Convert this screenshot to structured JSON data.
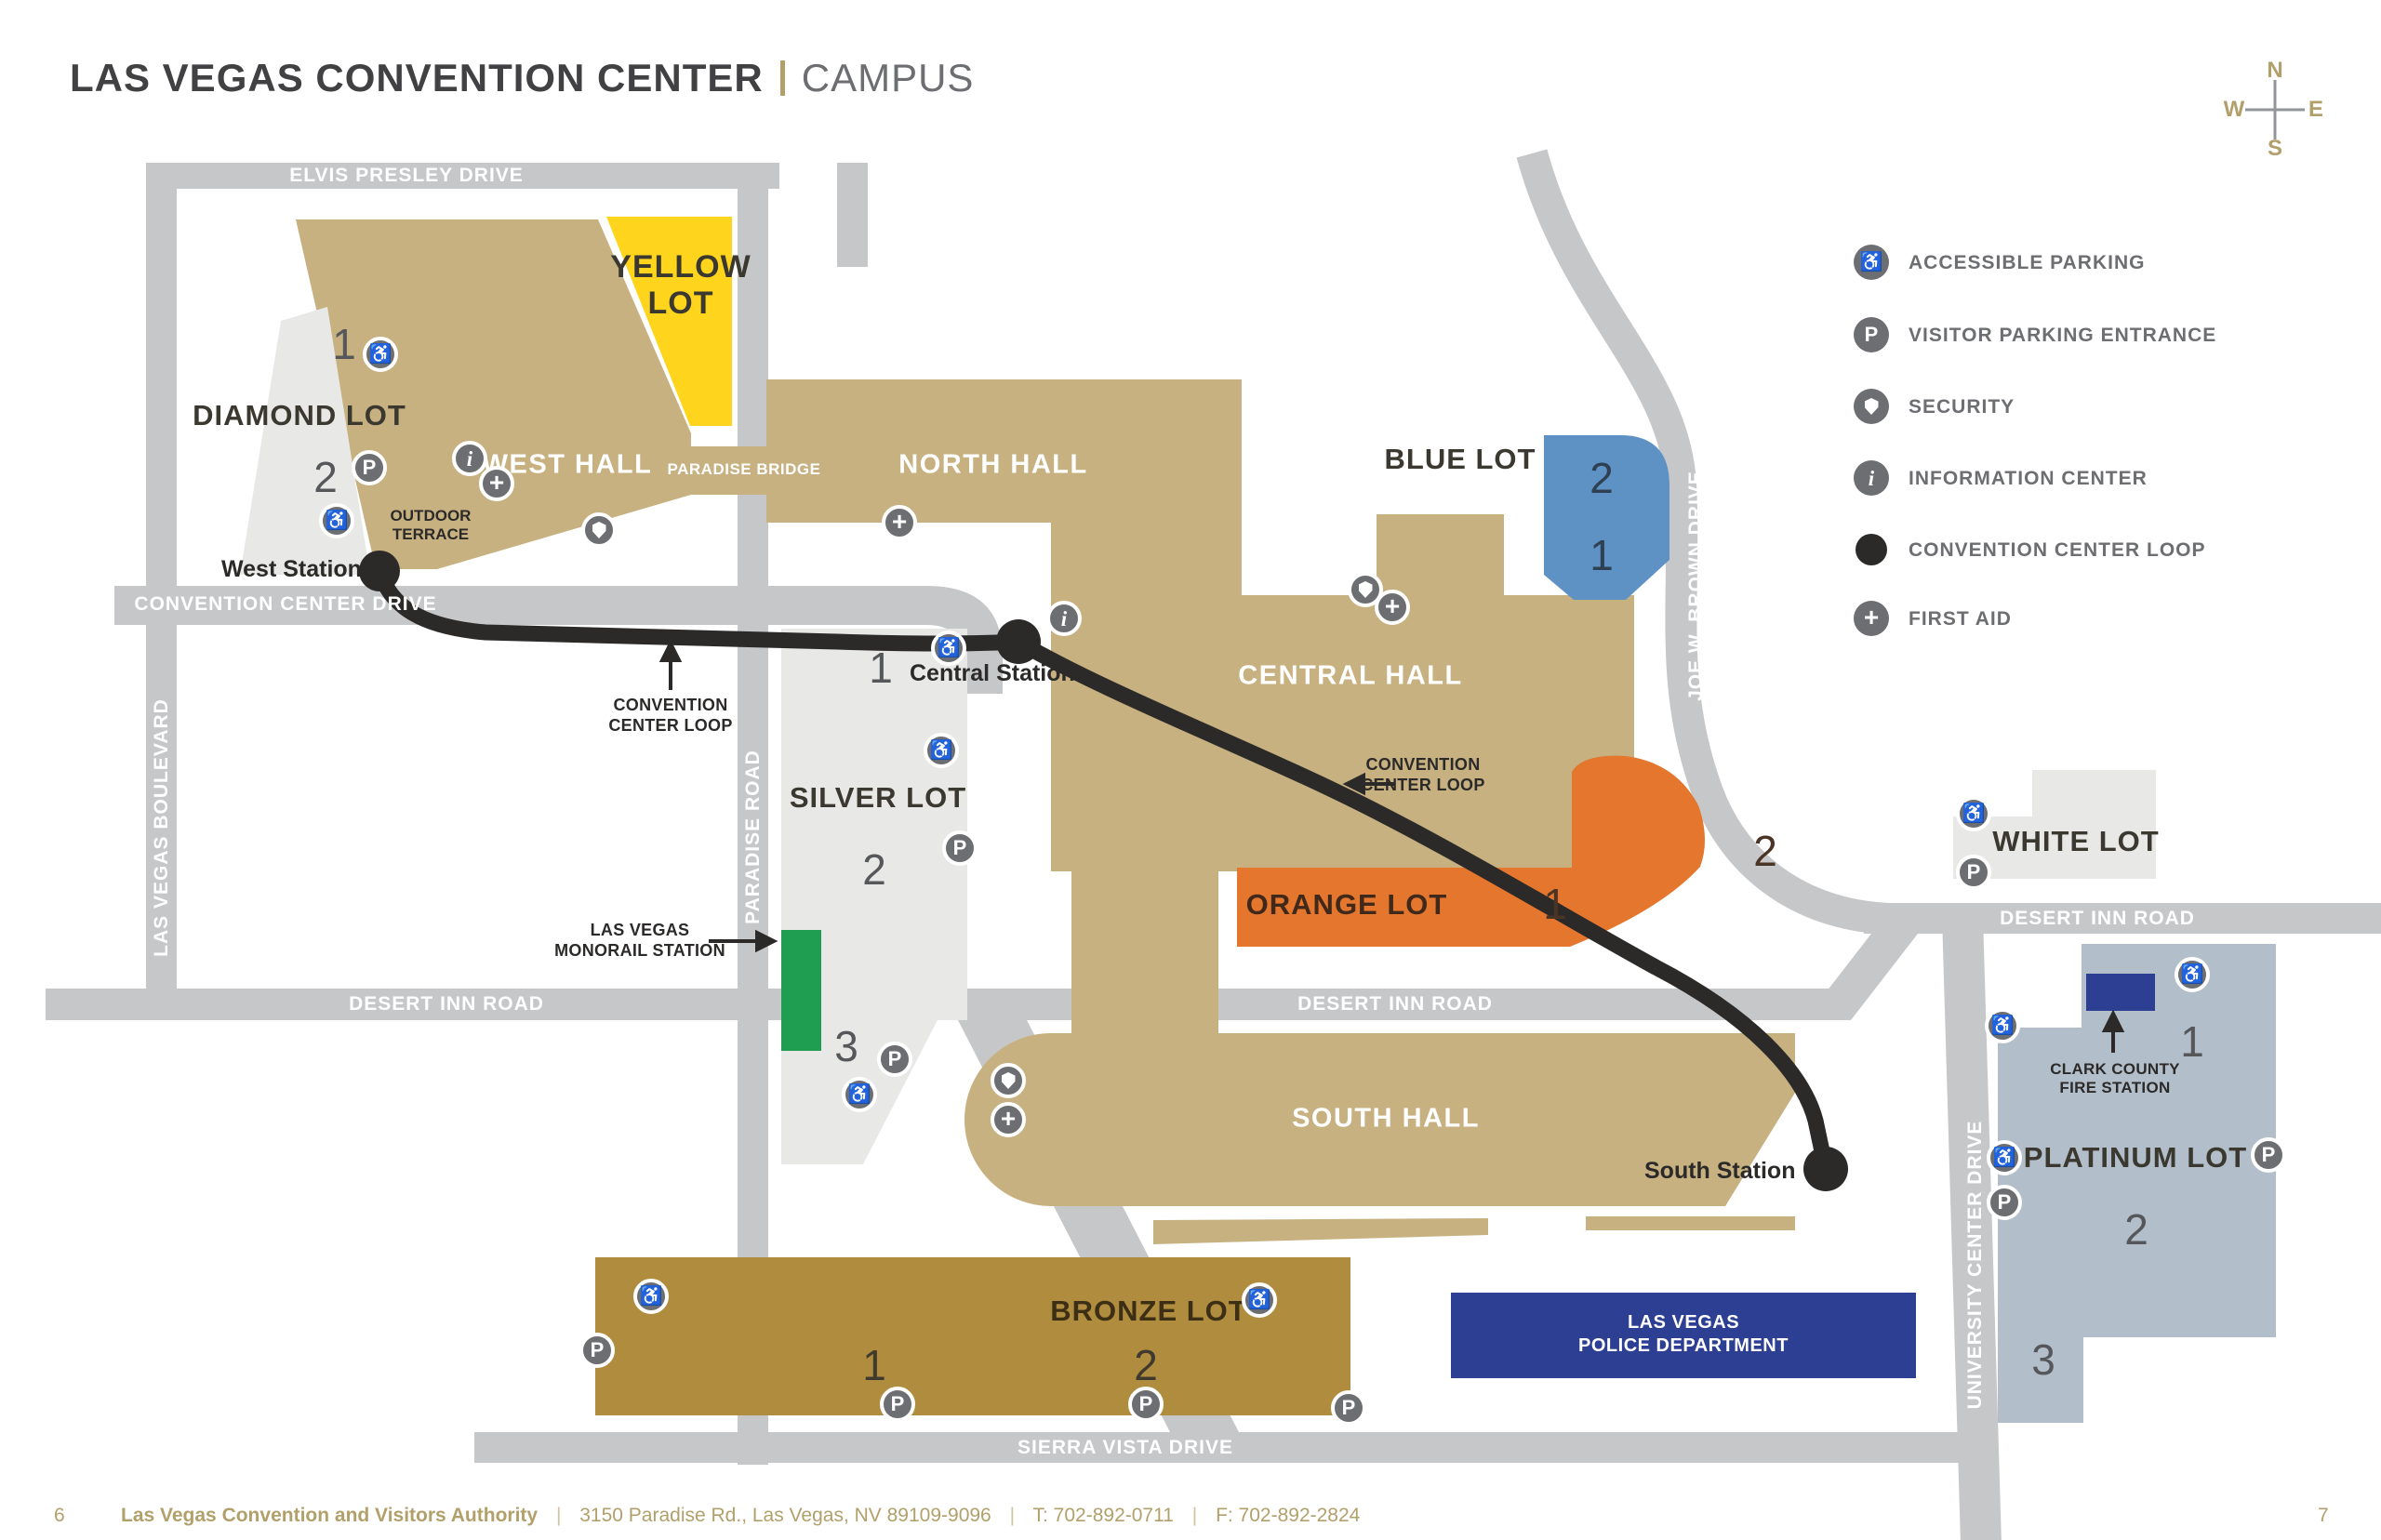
{
  "title": {
    "main": "LAS VEGAS CONVENTION CENTER",
    "sub": "CAMPUS"
  },
  "compass": {
    "n": "N",
    "w": "W",
    "e": "E",
    "s": "S"
  },
  "legend": {
    "items": [
      {
        "icon": "accessible-parking-icon",
        "label": "ACCESSIBLE PARKING"
      },
      {
        "icon": "visitor-parking-icon",
        "label": "VISITOR PARKING ENTRANCE"
      },
      {
        "icon": "security-icon",
        "label": "SECURITY"
      },
      {
        "icon": "information-icon",
        "label": "INFORMATION CENTER"
      },
      {
        "icon": "loop-icon",
        "label": "CONVENTION CENTER LOOP"
      },
      {
        "icon": "first-aid-icon",
        "label": "FIRST AID"
      }
    ]
  },
  "glyphs": {
    "accessible": "♿",
    "parking": "P",
    "info": "i",
    "first_aid": "+"
  },
  "roads": {
    "elvis_presley": "ELVIS PRESLEY DRIVE",
    "las_vegas_blvd": "LAS VEGAS BOULEVARD",
    "convention_center_dr": "CONVENTION CENTER DRIVE",
    "paradise_rd": "PARADISE ROAD",
    "desert_inn": "DESERT INN ROAD",
    "sierra_vista": "SIERRA VISTA DRIVE",
    "joe_w_brown": "JOE W. BROWN DRIVE",
    "university_center": "UNIVERSITY CENTER DRIVE"
  },
  "halls": {
    "west": "WEST HALL",
    "north": "NORTH HALL",
    "central": "CENTRAL HALL",
    "south": "SOUTH HALL",
    "paradise_bridge": "PARADISE BRIDGE",
    "outdoor_terrace_1": "OUTDOOR",
    "outdoor_terrace_2": "TERRACE"
  },
  "lots": {
    "yellow": {
      "name_1": "YELLOW",
      "name_2": "LOT"
    },
    "diamond": {
      "name": "DIAMOND LOT",
      "numbers": [
        "1",
        "2"
      ]
    },
    "silver": {
      "name": "SILVER LOT",
      "numbers": [
        "1",
        "2",
        "3"
      ]
    },
    "blue": {
      "name": "BLUE LOT",
      "numbers": [
        "2",
        "1"
      ]
    },
    "orange": {
      "name": "ORANGE LOT",
      "numbers": [
        "1",
        "2"
      ]
    },
    "white": {
      "name": "WHITE LOT"
    },
    "platinum": {
      "name": "PLATINUM LOT",
      "numbers": [
        "1",
        "2",
        "3"
      ]
    },
    "bronze": {
      "name": "BRONZE LOT",
      "numbers": [
        "1",
        "2"
      ]
    }
  },
  "loop": {
    "west_station": "West Station",
    "central_station": "Central Station",
    "south_station": "South Station",
    "label_1": "CONVENTION",
    "label_2": "CENTER LOOP"
  },
  "monorail": {
    "label_1": "LAS VEGAS",
    "label_2": "MONORAIL STATION"
  },
  "pois": {
    "police_1": "LAS VEGAS",
    "police_2": "POLICE DEPARTMENT",
    "fire_1": "CLARK COUNTY",
    "fire_2": "FIRE STATION"
  },
  "footer": {
    "page_left": "6",
    "org": "Las Vegas Convention and Visitors Authority",
    "address": "3150 Paradise Rd., Las Vegas, NV 89109-9096",
    "phone": "T: 702-892-0711",
    "fax": "F: 702-892-2824",
    "sep": "|",
    "page_right": "7"
  },
  "colors": {
    "road": "#c6c7c9",
    "hall_tan": "#c7b181",
    "bronze": "#b08d3e",
    "yellow": "#ffd41c",
    "blue": "#5e92c5",
    "orange": "#e4762d",
    "light_lot": "#e8e9e7",
    "platinum": "#b2bec9",
    "monorail_green": "#1f9e52",
    "navy": "#2c3f93",
    "loop_black": "#2b2a29",
    "gold": "#b2a06b",
    "gray_text": "#6d6e71",
    "dark_text": "#414042"
  }
}
